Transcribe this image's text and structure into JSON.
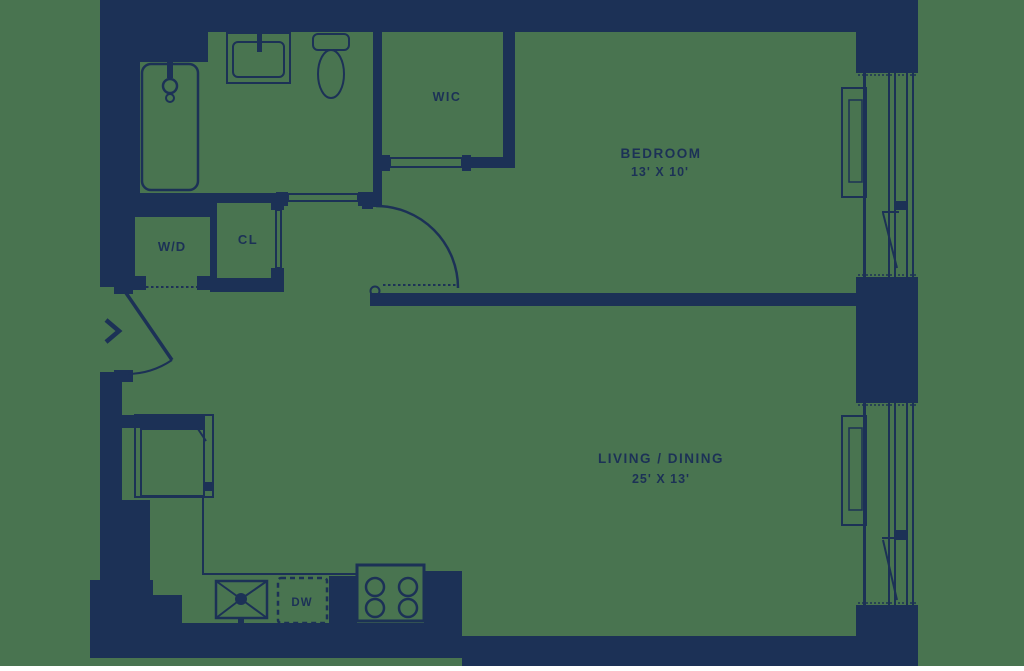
{
  "colors": {
    "wall": "#1C3156",
    "background": "#497450"
  },
  "rooms": {
    "bedroom": {
      "name": "BEDROOM",
      "dimensions": "13' X 10'"
    },
    "living_dining": {
      "name": "LIVING / DINING",
      "dimensions": "25' X 13'"
    },
    "wic": {
      "name": "WIC"
    },
    "washer_dryer": {
      "name": "W/D"
    },
    "closet": {
      "name": "CL"
    },
    "dishwasher": {
      "name": "DW"
    }
  }
}
